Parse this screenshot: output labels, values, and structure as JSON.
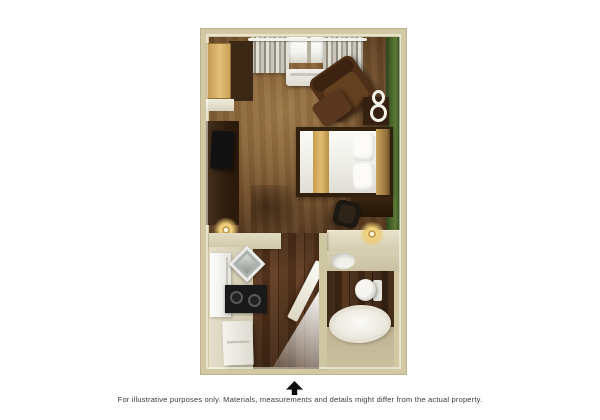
{
  "caption": {
    "text": "For illustrative purposes only.  Materials, measurements and details might differ from the actual property."
  },
  "floor_plan": {
    "type": "studio-suite-floor-plan",
    "view": "3d-top-down-rendering",
    "rooms": [
      {
        "name": "living-sleeping-area",
        "fixtures": [
          "window-with-curtains",
          "wall-air-conditioner",
          "closet-with-shelf",
          "dresser-with-tv",
          "armchair",
          "ottoman",
          "side-table-with-scroll-decor",
          "bed-with-gold-runner",
          "nightstand",
          "desk-chair",
          "desk-counter-with-lamp",
          "wall-sconce"
        ]
      },
      {
        "name": "kitchen",
        "fixtures": [
          "refrigerator",
          "corner-sink",
          "stove-cooktop",
          "base-cabinet",
          "counter-half-wall"
        ]
      },
      {
        "name": "hallway",
        "fixtures": [
          "entry-door-open"
        ]
      },
      {
        "name": "bathroom",
        "fixtures": [
          "vanity-sink",
          "toilet",
          "bathtub"
        ]
      }
    ],
    "colors": {
      "background": "#ffffff",
      "wall": "#d2c9a4",
      "accent_wall_green": "#4e6a2c",
      "wood_floor": "#8a6539",
      "plank_floor": "#573823",
      "counter": "#d8d1b8",
      "linens": "#f4f3ee",
      "bed_runner": "#d2ab5e"
    },
    "compass": {
      "icon": "north-arrow",
      "direction": "up"
    }
  }
}
